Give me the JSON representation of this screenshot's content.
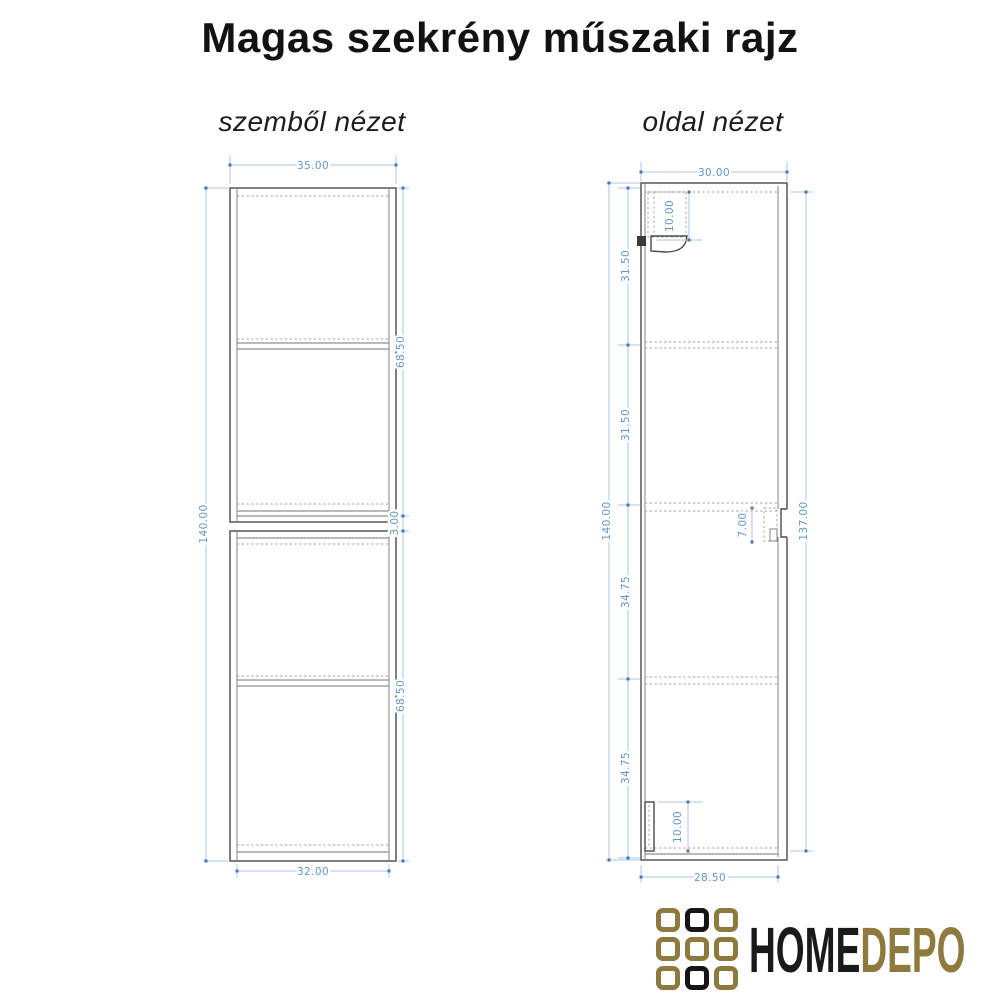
{
  "page": {
    "title": "Magas szekrény műszaki rajz"
  },
  "views": {
    "front": {
      "label": "szemből nézet",
      "dims": {
        "overall_width": "35.00",
        "overall_height": "140.00",
        "upper_door": "68.50",
        "door_gap": "3.00",
        "lower_door": "68.50",
        "inner_width": "32.00"
      }
    },
    "side": {
      "label": "oldal nézet",
      "dims": {
        "overall_depth": "30.00",
        "overall_height": "140.00",
        "section_1": "31.50",
        "section_2": "31.50",
        "section_3": "34.75",
        "section_4": "34.75",
        "hanger_bracket": "10.00",
        "handle_rail": "7.00",
        "base_bracket": "10.00",
        "door_height": "137.00",
        "inner_depth": "28.50"
      }
    }
  },
  "logo": {
    "home": "HOME",
    "depo": "DEPO",
    "grid": [
      "gold",
      "black",
      "gold",
      "gold",
      "gold",
      "gold",
      "gold",
      "black",
      "gold"
    ],
    "colors": {
      "gold": "#8d7a3c",
      "black": "#151515"
    }
  },
  "style_colors": {
    "dimension_line": "#a9c6e5",
    "dimension_text": "#5e96d2",
    "dimension_marker": "#4179b8",
    "drawing_line": "#4a4a4a",
    "hidden_line": "#9d9d9d"
  }
}
